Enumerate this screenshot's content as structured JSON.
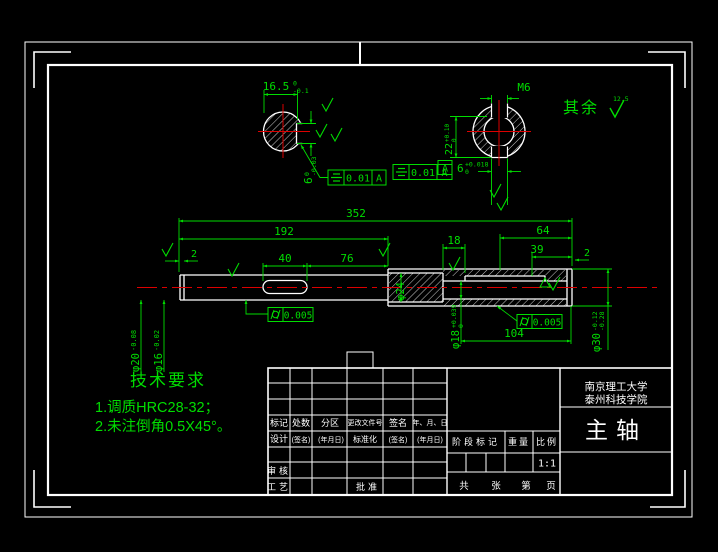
{
  "colors": {
    "line_green": "#00dd00",
    "outline_white": "#ffffff",
    "centerline_red": "#dd0000",
    "background": "#000000"
  },
  "dims": {
    "overall": "352",
    "left_len": "192",
    "slot_len": "40",
    "slot_to_step": "76",
    "groove_left": "2",
    "wall": "18",
    "bore_a": "64",
    "bore_b": "39",
    "chamfer_right": "2",
    "bore_depth": "104",
    "dia_body": "φ20",
    "dia_body_tol": "-0.08",
    "dia_tip": "φ16",
    "dia_tip_tol": "-0.02",
    "dia_core": "φ24",
    "dia_bore": "φ18",
    "dia_bore_sup": "+0.039",
    "dia_bore_sub": "0",
    "dia_right": "φ30",
    "dia_right_sup": "-0.12",
    "dia_right_sub": "-0.28",
    "key_flat": "16.5",
    "key_flat_sup": "0",
    "key_flat_sub": "-0.1",
    "key_width": "6",
    "key_width_sup": "0",
    "key_width_sub": "-0.03",
    "hub_depth": "22",
    "hub_depth_sup": "+0.10",
    "hub_depth_sub": "0",
    "hub_key": "6",
    "hub_key_sup": "+0.018",
    "hub_key_sub": "0",
    "thread": "M6"
  },
  "gdt": {
    "f1_val": "0.01",
    "f1_datum": "A",
    "f2_val": "0.01",
    "f2_datum": "A",
    "c1_val": "0.005",
    "c2_val": "0.005",
    "datum": "A"
  },
  "notes": {
    "rest": "其余",
    "rest_val": "12.5"
  },
  "tech": {
    "title": "技术要求",
    "line1": "1.调质HRC28-32；",
    "line2": "2.未注倒角0.5X45°。"
  },
  "tb": {
    "c1": "标记",
    "c2": "处数",
    "c3": "分区",
    "c4": "更改文件号",
    "c5": "签名",
    "c6": "年、月、日",
    "r2c1": "设计",
    "r2c2": "(签名)",
    "r2c3": "(年月日)",
    "r2c4": "标准化",
    "r2c5": "(签名)",
    "r2c6": "(年月日)",
    "shenhe": "审核",
    "gongyi": "工艺",
    "pizhun": "批准",
    "stage": "阶段标记",
    "weight": "重量",
    "scale_label": "比例",
    "scale": "1:1",
    "sheets1": "共",
    "sheets2": "张",
    "page1": "第",
    "page2": "页",
    "org1": "南京理工大学",
    "org2": "泰州科技学院",
    "title": "主轴"
  }
}
